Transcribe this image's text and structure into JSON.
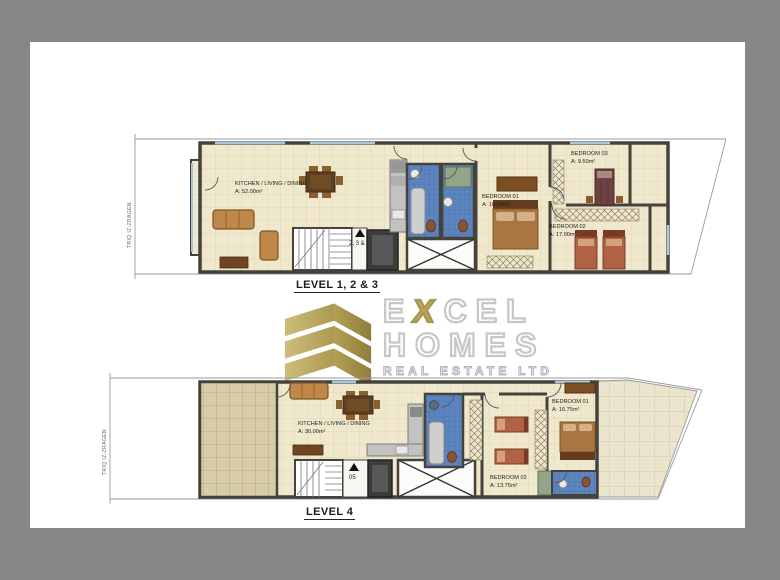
{
  "background_color": "#878787",
  "paper_color": "#ffffff",
  "palette": {
    "wall": "#45423c",
    "floor_tile": "#f0e8cd",
    "terrace_tile": "#d8cda6",
    "bathroom_tile": "#5c85c0",
    "furniture_wood": "#c08848",
    "logo_gold": "#b9a75f"
  },
  "street": "TRIQ IZ-ZRAGEN",
  "logo": {
    "excel_pre": "E",
    "excel_x": "X",
    "excel_post": "CEL",
    "homes": "HOMES",
    "tagline": "REAL ESTATE LTD"
  },
  "upper_plan": {
    "level_label": "LEVEL 1, 2 & 3",
    "stair_label": "2, 3 & 4",
    "kitchen": {
      "name": "KITCHEN / LIVING / DINING",
      "area": "A: 52.00m²"
    },
    "bedroom1": {
      "name": "BEDROOM 01",
      "area": "A: 16.50m²"
    },
    "bedroom2": {
      "name": "BEDROOM 02",
      "area": "A: 17.00m²"
    },
    "bedroom3": {
      "name": "BEDROOM 03",
      "area": "A: 9.50m²"
    }
  },
  "lower_plan": {
    "level_label": "LEVEL 4",
    "stair_label": "05",
    "kitchen": {
      "name": "KITCHEN / LIVING / DINING",
      "area": "A: 30.00m²"
    },
    "bedroom1": {
      "name": "BEDROOM 01",
      "area": "A: 16.75m²"
    },
    "bedroom2": {
      "name": "BEDROOM 02",
      "area": "A: 13.75m²"
    }
  }
}
